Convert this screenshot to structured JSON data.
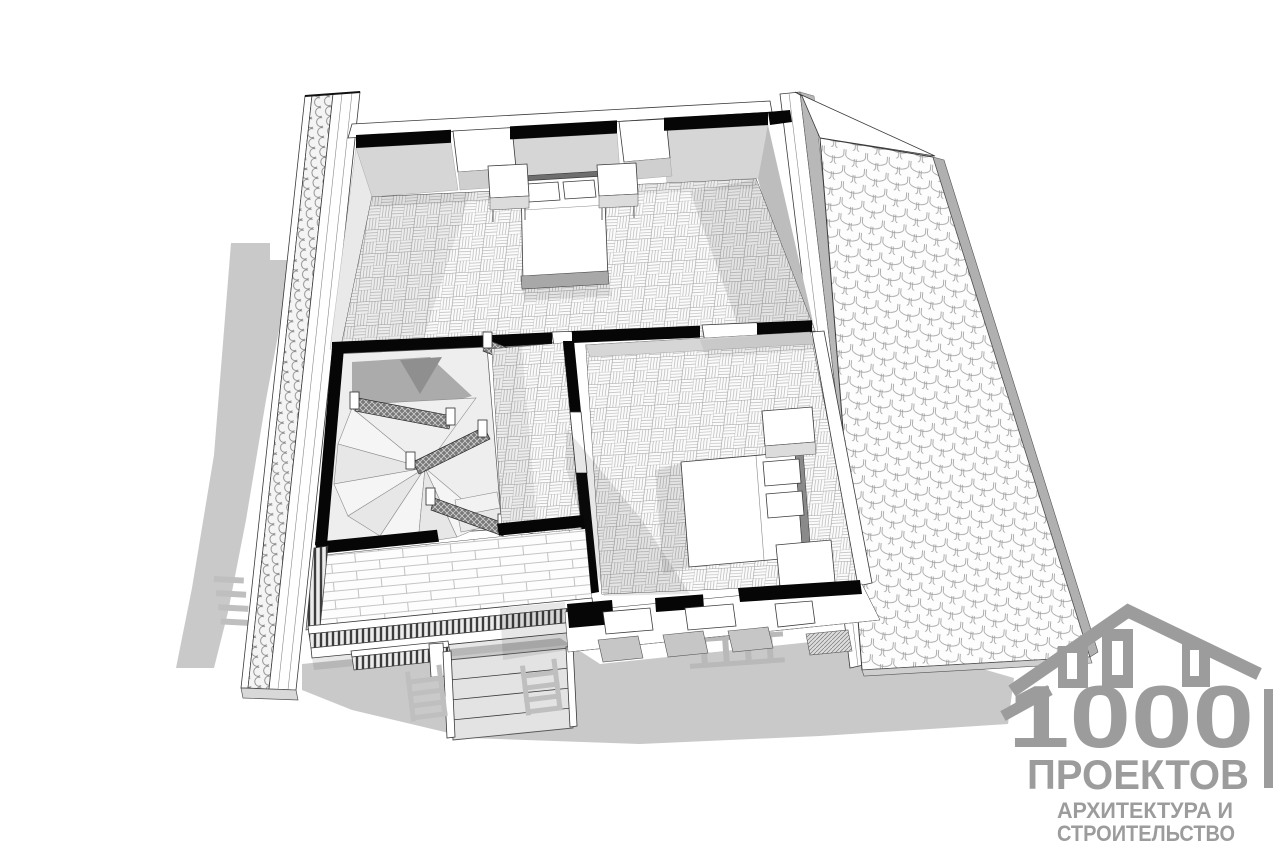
{
  "logo": {
    "number": "1000",
    "name": "ПРОЕКТОВ",
    "tagline_line1": "АРХИТЕКТУРА И",
    "tagline_line2": "СТРОИТЕЛЬСТВО",
    "color": "#9c9c9c"
  },
  "palette": {
    "bg": "#ffffff",
    "ink": "#3a3a3a",
    "wall": "#060606",
    "shadow": "#c9c9c9",
    "floorline": "#ababab",
    "graywall": "#d6d6d6",
    "graydark": "#bdbdbd",
    "logo": "#9c9c9c"
  }
}
